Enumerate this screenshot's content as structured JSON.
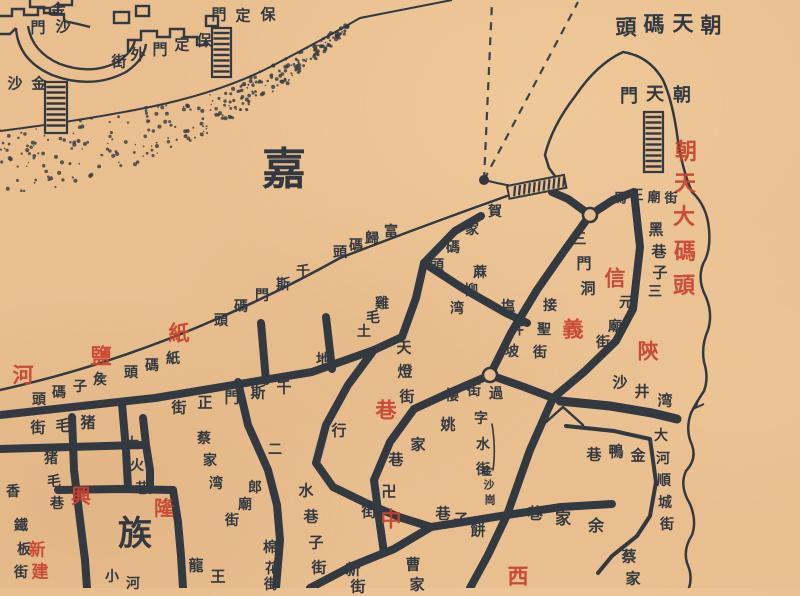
{
  "map": {
    "colors": {
      "paper": "#e9bf90",
      "ink": "#323941",
      "red": "#c8432e"
    },
    "symbols": {
      "stairs_icon": "hatched-ladder",
      "wharf_dock_icon": "hatched-bar",
      "ferry_route_icon": "dashed-line",
      "ferry_origin_icon": "filled-dot",
      "intersection_icon": "open-circle-node",
      "sand_bank_icon": "stipple-dots"
    },
    "map_labels": [
      {
        "name": "jinsha-gate-label",
        "text": "金沙門",
        "color": "ink",
        "size": 15,
        "chars": [
          [
            58,
            10
          ],
          [
            63,
            27
          ],
          [
            38,
            28
          ]
        ]
      },
      {
        "name": "baoding-gate-label",
        "text": "保定門",
        "color": "ink",
        "size": 15,
        "chars": [
          [
            268,
            15
          ],
          [
            243,
            16
          ],
          [
            219,
            15
          ]
        ]
      },
      {
        "name": "baoding-gate-outer-street-label",
        "text": "保定門外街",
        "color": "ink",
        "size": 15,
        "chars": [
          [
            204,
            41
          ],
          [
            182,
            45
          ],
          [
            160,
            50
          ],
          [
            138,
            55
          ],
          [
            119,
            62
          ]
        ]
      },
      {
        "name": "jinsha-label",
        "text": "金沙",
        "color": "ink",
        "size": 15,
        "chars": [
          [
            39,
            84
          ],
          [
            15,
            84
          ]
        ]
      },
      {
        "name": "jialing-river-char",
        "text": "嘉",
        "color": "ink",
        "size": 44,
        "chars": [
          [
            284,
            170
          ]
        ]
      },
      {
        "name": "zhiyanhe-red-label",
        "text": "紙鹽河",
        "color": "red",
        "size": 21,
        "chars": [
          [
            179,
            333
          ],
          [
            101,
            356
          ],
          [
            23,
            375
          ]
        ]
      },
      {
        "name": "qiansimen-wharf-label",
        "text": "千斯門碼頭",
        "color": "ink",
        "size": 14,
        "chars": [
          [
            303,
            272
          ],
          [
            283,
            285
          ],
          [
            262,
            296
          ],
          [
            241,
            307
          ],
          [
            221,
            321
          ]
        ]
      },
      {
        "name": "fugui-wharf-label",
        "text": "富歸碼頭",
        "color": "ink",
        "size": 14,
        "chars": [
          [
            391,
            232
          ],
          [
            372,
            239
          ],
          [
            356,
            246
          ],
          [
            340,
            253
          ]
        ]
      },
      {
        "name": "zhi-wharf-label",
        "text": "紙碼頭",
        "color": "ink",
        "size": 14,
        "chars": [
          [
            173,
            359
          ],
          [
            152,
            366
          ],
          [
            131,
            373
          ]
        ]
      },
      {
        "name": "houzi-wharf-label",
        "text": "矦子碼頭",
        "color": "ink",
        "size": 14,
        "chars": [
          [
            100,
            380
          ],
          [
            80,
            387
          ],
          [
            59,
            393
          ],
          [
            39,
            400
          ]
        ]
      },
      {
        "name": "hejia-wharf-label",
        "text": "賀家碼頭",
        "color": "ink",
        "size": 14,
        "chars": [
          [
            495,
            212
          ],
          [
            472,
            230
          ],
          [
            453,
            248
          ],
          [
            437,
            266
          ]
        ]
      },
      {
        "name": "chaotian-wharf-label",
        "text": "朝天碼頭",
        "color": "ink",
        "size": 21,
        "chars": [
          [
            711,
            25
          ],
          [
            683,
            23
          ],
          [
            654,
            24
          ],
          [
            626,
            27
          ]
        ]
      },
      {
        "name": "chaotian-gate-label",
        "text": "朝天門",
        "color": "ink",
        "size": 18,
        "chars": [
          [
            682,
            96
          ],
          [
            655,
            95
          ],
          [
            629,
            97
          ]
        ]
      },
      {
        "name": "chaotian-big-wharf-red-label",
        "text": "朝天大碼頭",
        "color": "red",
        "size": 22,
        "chars": [
          [
            686,
            152
          ],
          [
            685,
            184
          ],
          [
            684,
            217
          ],
          [
            685,
            252
          ],
          [
            684,
            286
          ]
        ]
      },
      {
        "name": "mawang-temple-street-label",
        "text": "馬王廟街",
        "color": "ink",
        "size": 13,
        "chars": [
          [
            620,
            199
          ],
          [
            637,
            196
          ],
          [
            654,
            198
          ],
          [
            671,
            199
          ]
        ]
      },
      {
        "name": "hei-alley-label",
        "text": "黑巷子",
        "color": "ink",
        "size": 15,
        "chars": [
          [
            656,
            230
          ],
          [
            659,
            252
          ],
          [
            660,
            273
          ]
        ]
      },
      {
        "name": "sanyuan-temple-street-label",
        "text": "三元廟街",
        "color": "ink",
        "size": 14,
        "chars": [
          [
            655,
            292
          ],
          [
            626,
            303
          ],
          [
            615,
            327
          ],
          [
            603,
            343
          ]
        ]
      },
      {
        "name": "sanmendong-label",
        "text": "三門洞",
        "color": "ink",
        "size": 15,
        "chars": [
          [
            579,
            239
          ],
          [
            584,
            264
          ],
          [
            588,
            289
          ]
        ]
      },
      {
        "name": "jiesheng-street-label",
        "text": "接聖街",
        "color": "ink",
        "size": 14,
        "chars": [
          [
            550,
            306
          ],
          [
            544,
            330
          ],
          [
            540,
            353
          ]
        ]
      },
      {
        "name": "xinyi-red-label",
        "text": "信義",
        "color": "red",
        "size": 21,
        "chars": [
          [
            615,
            278
          ],
          [
            573,
            329
          ]
        ]
      },
      {
        "name": "shan-red-label",
        "text": "陝",
        "color": "red",
        "size": 21,
        "chars": [
          [
            648,
            351
          ]
        ]
      },
      {
        "name": "yanjingpo-label",
        "text": "塩井坡",
        "color": "ink",
        "size": 14,
        "chars": [
          [
            508,
            307
          ],
          [
            517,
            330
          ],
          [
            512,
            352
          ]
        ]
      },
      {
        "name": "maliuwan-label",
        "text": "蔴柳湾",
        "color": "ink",
        "size": 14,
        "chars": [
          [
            480,
            273
          ],
          [
            471,
            291
          ],
          [
            457,
            309
          ]
        ]
      },
      {
        "name": "jimao-tudi-label",
        "text": "雞毛土地",
        "color": "ink",
        "size": 14,
        "chars": [
          [
            382,
            304
          ],
          [
            373,
            318
          ],
          [
            364,
            332
          ],
          [
            323,
            360
          ]
        ]
      },
      {
        "name": "tiandeng-street-label",
        "text": "天燈街",
        "color": "ink",
        "size": 15,
        "chars": [
          [
            404,
            348
          ],
          [
            405,
            372
          ],
          [
            407,
            397
          ]
        ]
      },
      {
        "name": "xing-char-label",
        "text": "行",
        "color": "ink",
        "size": 15,
        "chars": [
          [
            339,
            431
          ]
        ]
      },
      {
        "name": "guojielou-label",
        "text": "過街樓",
        "color": "ink",
        "size": 14,
        "chars": [
          [
            496,
            394
          ],
          [
            474,
            391
          ],
          [
            452,
            396
          ]
        ]
      },
      {
        "name": "shajingwan-label",
        "text": "沙井湾",
        "color": "ink",
        "size": 15,
        "chars": [
          [
            620,
            383
          ],
          [
            642,
            392
          ],
          [
            665,
            401
          ]
        ]
      },
      {
        "name": "dahe-shuncheng-street-label",
        "text": "大河順城街",
        "color": "ink",
        "size": 14,
        "chars": [
          [
            661,
            436
          ],
          [
            663,
            459
          ],
          [
            664,
            481
          ],
          [
            665,
            503
          ],
          [
            667,
            525
          ]
        ]
      },
      {
        "name": "jinya-alley-label",
        "text": "金鴨巷",
        "color": "ink",
        "size": 15,
        "chars": [
          [
            638,
            456
          ],
          [
            616,
            452
          ],
          [
            594,
            455
          ]
        ]
      },
      {
        "name": "yujia-alley-label",
        "text": "余家巷",
        "color": "ink",
        "size": 16,
        "chars": [
          [
            596,
            526
          ],
          [
            563,
            519
          ],
          [
            535,
            514
          ]
        ]
      },
      {
        "name": "caijia-partial-label",
        "text": "蔡家",
        "color": "ink",
        "size": 15,
        "chars": [
          [
            629,
            557
          ],
          [
            633,
            579
          ]
        ]
      },
      {
        "name": "yaojia-alley-label",
        "text": "姚家巷",
        "color": "ink",
        "size": 15,
        "chars": [
          [
            448,
            425
          ],
          [
            418,
            445
          ],
          [
            396,
            460
          ]
        ]
      },
      {
        "name": "wan-street-label",
        "text": "卍街",
        "color": "ink",
        "size": 15,
        "chars": [
          [
            389,
            492
          ],
          [
            369,
            512
          ]
        ]
      },
      {
        "name": "zhong-red-label",
        "text": "中",
        "color": "red",
        "size": 21,
        "chars": [
          [
            391,
            519
          ]
        ]
      },
      {
        "name": "xiang-red-label",
        "text": "巷",
        "color": "red",
        "size": 21,
        "chars": [
          [
            386,
            410
          ]
        ]
      },
      {
        "name": "xi-red-label",
        "text": "西",
        "color": "red",
        "size": 21,
        "chars": [
          [
            518,
            576
          ]
        ]
      },
      {
        "name": "zishui-street-label",
        "text": "字水街",
        "color": "ink",
        "size": 14,
        "chars": [
          [
            481,
            419
          ],
          [
            483,
            445
          ],
          [
            483,
            470
          ]
        ]
      },
      {
        "name": "jinshagang-label",
        "text": "金沙崗",
        "color": "ink",
        "size": 11,
        "chars": [
          [
            487,
            471
          ],
          [
            489,
            485
          ],
          [
            490,
            500
          ]
        ]
      },
      {
        "name": "bingzi-alley-label",
        "text": "餅子巷",
        "color": "ink",
        "size": 15,
        "chars": [
          [
            478,
            531
          ],
          [
            461,
            520
          ],
          [
            443,
            514
          ]
        ]
      },
      {
        "name": "caojia-partial-label",
        "text": "曹家",
        "color": "ink",
        "size": 15,
        "chars": [
          [
            413,
            565
          ],
          [
            417,
            585
          ]
        ]
      },
      {
        "name": "xinjie-partial-label",
        "text": "新街",
        "color": "ink",
        "size": 15,
        "chars": [
          [
            353,
            570
          ],
          [
            358,
            587
          ]
        ]
      },
      {
        "name": "qiansimen-main-street-label",
        "text": "千斯門正街",
        "color": "ink",
        "size": 15,
        "chars": [
          [
            284,
            388
          ],
          [
            258,
            393
          ],
          [
            232,
            398
          ],
          [
            205,
            403
          ],
          [
            179,
            408
          ]
        ]
      },
      {
        "name": "zhumao-street-label",
        "text": "猪毛街",
        "color": "ink",
        "size": 15,
        "chars": [
          [
            88,
            423
          ],
          [
            63,
            426
          ],
          [
            38,
            428
          ]
        ]
      },
      {
        "name": "zhumao-alley-label",
        "text": "猪毛巷",
        "color": "ink",
        "size": 14,
        "chars": [
          [
            51,
            459
          ],
          [
            54,
            482
          ],
          [
            57,
            504
          ]
        ]
      },
      {
        "name": "dahuo-alley-label",
        "text": "大火巷",
        "color": "ink",
        "size": 14,
        "chars": [
          [
            132,
            444
          ],
          [
            137,
            466
          ],
          [
            142,
            489
          ]
        ]
      },
      {
        "name": "caijiawan-label",
        "text": "蔡家湾",
        "color": "ink",
        "size": 14,
        "chars": [
          [
            204,
            439
          ],
          [
            210,
            461
          ],
          [
            216,
            484
          ]
        ]
      },
      {
        "name": "erlang-temple-street-label",
        "text": "二郎廟街",
        "color": "ink",
        "size": 14,
        "chars": [
          [
            275,
            450
          ],
          [
            255,
            488
          ],
          [
            245,
            505
          ],
          [
            232,
            521
          ]
        ]
      },
      {
        "name": "shuixiangzi-street-label",
        "text": "水巷子街",
        "color": "ink",
        "size": 15,
        "chars": [
          [
            306,
            491
          ],
          [
            311,
            517
          ],
          [
            316,
            543
          ],
          [
            319,
            568
          ]
        ]
      },
      {
        "name": "mianhua-street-label",
        "text": "棉花街",
        "color": "ink",
        "size": 14,
        "chars": [
          [
            270,
            548
          ],
          [
            272,
            569
          ],
          [
            271,
            585
          ]
        ]
      },
      {
        "name": "longwang-partial-label",
        "text": "龍王",
        "color": "ink",
        "size": 15,
        "chars": [
          [
            196,
            566
          ],
          [
            218,
            577
          ]
        ]
      },
      {
        "name": "xiaohe-partial-label",
        "text": "小河",
        "color": "ink",
        "size": 14,
        "chars": [
          [
            112,
            577
          ],
          [
            133,
            584
          ]
        ]
      },
      {
        "name": "tieban-street-label",
        "text": "鐵板街",
        "color": "ink",
        "size": 14,
        "chars": [
          [
            21,
            526
          ],
          [
            24,
            550
          ],
          [
            21,
            573
          ]
        ]
      },
      {
        "name": "xiang-partial-label",
        "text": "香",
        "color": "ink",
        "size": 14,
        "chars": [
          [
            13,
            492
          ]
        ]
      },
      {
        "name": "zu-big-char",
        "text": "族",
        "color": "ink",
        "size": 34,
        "chars": [
          [
            135,
            534
          ]
        ]
      },
      {
        "name": "xinglong-red-label",
        "text": "興隆",
        "color": "red",
        "size": 20,
        "chars": [
          [
            81,
            496
          ],
          [
            164,
            508
          ]
        ]
      },
      {
        "name": "xinjian-red-label",
        "text": "新建",
        "color": "red",
        "size": 17,
        "chars": [
          [
            37,
            551
          ],
          [
            40,
            573
          ]
        ]
      }
    ]
  }
}
